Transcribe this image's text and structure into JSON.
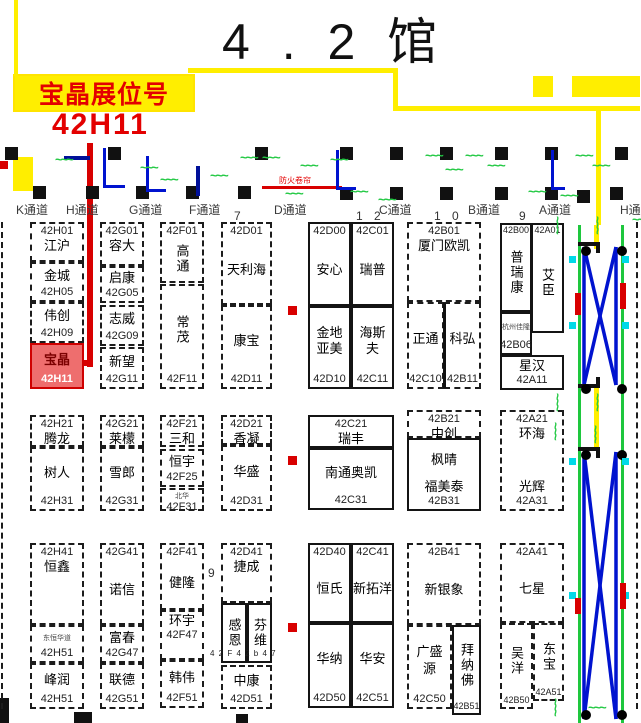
{
  "title": "4 . 2 馆",
  "banner": {
    "line1": "宝晶展位号",
    "line2": "42H11"
  },
  "fire_label": "防火卷帘",
  "labels": [
    {
      "t": "9",
      "x": 208,
      "y": 566,
      "c": "num9"
    },
    {
      "t": "4 2 F 4 2 b 4 7",
      "x": 210,
      "y": 649,
      "c": "cap"
    }
  ],
  "aisles": [
    {
      "t": "K通道",
      "x": 16
    },
    {
      "t": "H通道",
      "x": 66
    },
    {
      "t": "G通道",
      "x": 129
    },
    {
      "t": "F通道",
      "x": 189
    },
    {
      "t": "7",
      "x": 234,
      "num": true
    },
    {
      "t": "D通道",
      "x": 274
    },
    {
      "t": "1 2",
      "x": 356,
      "num": true
    },
    {
      "t": "C通道",
      "x": 379
    },
    {
      "t": "1 0",
      "x": 434,
      "num": true
    },
    {
      "t": "B通道",
      "x": 468
    },
    {
      "t": "9",
      "x": 519,
      "num": true
    },
    {
      "t": "A通道",
      "x": 539
    },
    {
      "t": "H通",
      "x": 620
    }
  ],
  "booths": [
    {
      "id": "42H01",
      "x": 30,
      "y": 222,
      "w": 54,
      "h": 40,
      "s": "dashed",
      "lines": [
        {
          "t": "42H01",
          "c": "id"
        },
        {
          "t": "江沪",
          "c": "nm"
        }
      ]
    },
    {
      "id": "42H05",
      "x": 30,
      "y": 262,
      "w": 54,
      "h": 40,
      "s": "dashed",
      "lines": [
        {
          "t": "金城",
          "c": "nm",
          "g": 1
        },
        {
          "t": "42H05",
          "c": "id"
        }
      ]
    },
    {
      "id": "42H09",
      "x": 30,
      "y": 302,
      "w": 54,
      "h": 41,
      "s": "dashed",
      "lines": [
        {
          "t": "伟创",
          "c": "nm",
          "g": 1
        },
        {
          "t": "42H09",
          "c": "id"
        }
      ]
    },
    {
      "id": "42H11",
      "x": 30,
      "y": 343,
      "w": 54,
      "h": 46,
      "s": "dashed",
      "hl": true,
      "lines": [
        {
          "t": "宝晶",
          "c": "nm",
          "g": 1
        },
        {
          "t": "42H11",
          "c": "id"
        }
      ]
    },
    {
      "id": "42G01",
      "x": 100,
      "y": 222,
      "w": 44,
      "h": 44,
      "s": "dashed",
      "lines": [
        {
          "t": "42G01",
          "c": "id"
        },
        {
          "t": "容大",
          "c": "nm"
        }
      ]
    },
    {
      "id": "42G05",
      "x": 100,
      "y": 266,
      "w": 44,
      "h": 37,
      "s": "dashed",
      "lines": [
        {
          "t": "启康",
          "c": "nm",
          "g": 1
        },
        {
          "t": "42G05",
          "c": "id"
        }
      ]
    },
    {
      "id": "42G09",
      "x": 100,
      "y": 305,
      "w": 44,
      "h": 41,
      "s": "dashed",
      "lines": [
        {
          "t": "志威",
          "c": "nm",
          "g": 1
        },
        {
          "t": "42G09",
          "c": "id"
        }
      ]
    },
    {
      "id": "42G11",
      "x": 100,
      "y": 347,
      "w": 44,
      "h": 42,
      "s": "dashed",
      "lines": [
        {
          "t": "新望",
          "c": "nm",
          "g": 1
        },
        {
          "t": "42G11",
          "c": "id"
        }
      ]
    },
    {
      "id": "42F01",
      "x": 160,
      "y": 222,
      "w": 44,
      "h": 61,
      "s": "dashed",
      "lines": [
        {
          "t": "42F01",
          "c": "id"
        },
        {
          "t": "高通",
          "c": "vm"
        }
      ]
    },
    {
      "id": "42F11",
      "x": 160,
      "y": 284,
      "w": 44,
      "h": 105,
      "s": "dashed",
      "lines": [
        {
          "t": "常茂",
          "c": "vm"
        },
        {
          "t": "42F11",
          "c": "id"
        }
      ]
    },
    {
      "id": "42D01",
      "x": 221,
      "y": 222,
      "w": 51,
      "h": 83,
      "s": "dashed",
      "lines": [
        {
          "t": "42D01",
          "c": "id"
        },
        {
          "t": "天利海",
          "c": "nm",
          "g": 1
        }
      ]
    },
    {
      "id": "42D11",
      "x": 221,
      "y": 305,
      "w": 51,
      "h": 84,
      "s": "dashed",
      "lines": [
        {
          "t": "康宝",
          "c": "nm",
          "g": 1
        },
        {
          "t": "42D11",
          "c": "id"
        }
      ]
    },
    {
      "id": "42D00",
      "x": 308,
      "y": 222,
      "w": 43,
      "h": 84,
      "s": "solid",
      "lines": [
        {
          "t": "42D00",
          "c": "id"
        },
        {
          "t": "安心",
          "c": "nm",
          "g": 1
        }
      ]
    },
    {
      "id": "42C01",
      "x": 351,
      "y": 222,
      "w": 43,
      "h": 84,
      "s": "solid",
      "lines": [
        {
          "t": "42C01",
          "c": "id"
        },
        {
          "t": "瑞普",
          "c": "nm",
          "g": 1
        }
      ]
    },
    {
      "id": "42D10",
      "x": 308,
      "y": 306,
      "w": 43,
      "h": 83,
      "s": "solid",
      "lines": [
        {
          "c": "sp",
          "g": 1
        },
        {
          "t": "金地",
          "c": "nm"
        },
        {
          "t": "亚美",
          "c": "nm"
        },
        {
          "c": "sp",
          "g": 1
        },
        {
          "t": "42D10",
          "c": "id"
        }
      ]
    },
    {
      "id": "42C11",
      "x": 351,
      "y": 306,
      "w": 43,
      "h": 83,
      "s": "solid",
      "lines": [
        {
          "c": "sp",
          "g": 1
        },
        {
          "t": "海斯",
          "c": "nm"
        },
        {
          "t": "夫",
          "c": "nm"
        },
        {
          "c": "sp",
          "g": 1
        },
        {
          "t": "42C11",
          "c": "id"
        }
      ]
    },
    {
      "id": "42B01",
      "x": 407,
      "y": 222,
      "w": 74,
      "h": 80,
      "s": "dashed",
      "lines": [
        {
          "t": "42B01",
          "c": "id"
        },
        {
          "t": "厦门欧凯",
          "c": "nm"
        }
      ]
    },
    {
      "id": "42C10",
      "x": 407,
      "y": 302,
      "w": 37,
      "h": 87,
      "s": "dashed",
      "lines": [
        {
          "t": "正通",
          "c": "nm",
          "g": 1
        },
        {
          "t": "42C10",
          "c": "id"
        }
      ]
    },
    {
      "id": "42B11",
      "x": 444,
      "y": 302,
      "w": 37,
      "h": 87,
      "s": "dashed",
      "lines": [
        {
          "t": "科弘",
          "c": "nm",
          "g": 1
        },
        {
          "t": "42B11",
          "c": "id"
        }
      ]
    },
    {
      "id": "42B00",
      "x": 500,
      "y": 223,
      "w": 32,
      "h": 89,
      "s": "solid",
      "lines": [
        {
          "t": "42B00",
          "c": "idt"
        },
        {
          "t": "普瑞康",
          "c": "vm"
        }
      ]
    },
    {
      "id": "42A01",
      "x": 531,
      "y": 223,
      "w": 33,
      "h": 110,
      "s": "solid",
      "lines": [
        {
          "t": "42A01",
          "c": "idt"
        },
        {
          "t": "艾臣",
          "c": "vm"
        }
      ]
    },
    {
      "id": "42B06",
      "x": 500,
      "y": 312,
      "w": 32,
      "h": 43,
      "s": "solid",
      "lines": [
        {
          "t": "杭州佳隆",
          "c": "ty",
          "g": 1
        },
        {
          "t": "42B06",
          "c": "id"
        }
      ]
    },
    {
      "id": "42A11",
      "x": 500,
      "y": 355,
      "w": 64,
      "h": 35,
      "s": "solid",
      "lines": [
        {
          "t": "星汉",
          "c": "nm",
          "g": 1
        },
        {
          "t": "42A11",
          "c": "id"
        }
      ]
    },
    {
      "id": "42H21",
      "x": 30,
      "y": 415,
      "w": 54,
      "h": 32,
      "s": "dashed",
      "lines": [
        {
          "t": "42H21",
          "c": "id"
        },
        {
          "t": "腾龙",
          "c": "nm"
        }
      ]
    },
    {
      "id": "42H31",
      "x": 30,
      "y": 447,
      "w": 54,
      "h": 64,
      "s": "dashed",
      "lines": [
        {
          "t": "树人",
          "c": "nm",
          "g": 1
        },
        {
          "t": "42H31",
          "c": "id"
        }
      ]
    },
    {
      "id": "42G21",
      "x": 100,
      "y": 415,
      "w": 44,
      "h": 32,
      "s": "dashed",
      "lines": [
        {
          "t": "42G21",
          "c": "id"
        },
        {
          "t": "莱檬",
          "c": "nm"
        }
      ]
    },
    {
      "id": "42G31",
      "x": 100,
      "y": 447,
      "w": 44,
      "h": 64,
      "s": "dashed",
      "lines": [
        {
          "t": "雪郎",
          "c": "nm",
          "g": 1
        },
        {
          "t": "42G31",
          "c": "id"
        }
      ]
    },
    {
      "id": "42F21",
      "x": 160,
      "y": 415,
      "w": 44,
      "h": 32,
      "s": "dashed",
      "lines": [
        {
          "t": "42F21",
          "c": "id"
        },
        {
          "t": "三和",
          "c": "nm"
        }
      ]
    },
    {
      "id": "42F25",
      "x": 160,
      "y": 449,
      "w": 44,
      "h": 38,
      "s": "dashed",
      "lines": [
        {
          "t": "恒宇",
          "c": "nm",
          "g": 1
        },
        {
          "t": "42F25",
          "c": "id"
        }
      ]
    },
    {
      "id": "42F31",
      "x": 160,
      "y": 488,
      "w": 44,
      "h": 23,
      "s": "dashed",
      "lines": [
        {
          "t": "北华",
          "c": "ty"
        },
        {
          "t": "42F31",
          "c": "id"
        }
      ]
    },
    {
      "id": "42D21",
      "x": 221,
      "y": 415,
      "w": 51,
      "h": 30,
      "s": "dashed",
      "lines": [
        {
          "t": "42D21",
          "c": "id"
        },
        {
          "t": "香凝",
          "c": "nm"
        }
      ]
    },
    {
      "id": "42D31",
      "x": 221,
      "y": 445,
      "w": 51,
      "h": 66,
      "s": "dashed",
      "lines": [
        {
          "t": "华盛",
          "c": "nm",
          "g": 1
        },
        {
          "t": "42D31",
          "c": "id"
        }
      ]
    },
    {
      "id": "42C21",
      "x": 308,
      "y": 415,
      "w": 86,
      "h": 33,
      "s": "solid",
      "lines": [
        {
          "t": "42C21",
          "c": "id"
        },
        {
          "t": "瑞丰",
          "c": "nm"
        }
      ]
    },
    {
      "id": "42C31",
      "x": 308,
      "y": 448,
      "w": 86,
      "h": 62,
      "s": "solid",
      "lines": [
        {
          "t": "南通奥凯",
          "c": "nm",
          "g": 1
        },
        {
          "t": "42C31",
          "c": "id"
        }
      ]
    },
    {
      "id": "42B21",
      "x": 407,
      "y": 410,
      "w": 74,
      "h": 28,
      "s": "dashed",
      "lines": [
        {
          "t": "42B21",
          "c": "id"
        },
        {
          "t": "中创",
          "c": "nm"
        }
      ]
    },
    {
      "id": "42B31",
      "x": 407,
      "y": 438,
      "w": 74,
      "h": 73,
      "s": "solid",
      "lines": [
        {
          "c": "sp",
          "g": 1
        },
        {
          "t": "枫晴",
          "c": "nm"
        },
        {
          "c": "sp",
          "g": 1
        },
        {
          "t": "福美泰",
          "c": "nm"
        },
        {
          "t": "42B31",
          "c": "id"
        }
      ]
    },
    {
      "id": "42A21",
      "x": 500,
      "y": 410,
      "w": 64,
      "h": 101,
      "s": "dashed",
      "lines": [
        {
          "t": "42A21",
          "c": "id"
        },
        {
          "t": "环海",
          "c": "nm"
        },
        {
          "c": "sp",
          "g": 1
        },
        {
          "t": "光辉",
          "c": "nm"
        },
        {
          "t": "42A31",
          "c": "id"
        }
      ]
    },
    {
      "id": "42H41",
      "x": 30,
      "y": 543,
      "w": 54,
      "h": 82,
      "s": "dashed",
      "lines": [
        {
          "t": "42H41",
          "c": "id"
        },
        {
          "t": "恒鑫",
          "c": "nm"
        },
        {
          "c": "sp",
          "g": 1
        }
      ]
    },
    {
      "id": "42H51a",
      "x": 30,
      "y": 625,
      "w": 54,
      "h": 38,
      "s": "dashed",
      "lines": [
        {
          "t": "东恒华道",
          "c": "ty",
          "g": 1
        },
        {
          "t": "42H51",
          "c": "id"
        }
      ]
    },
    {
      "id": "42H51b",
      "x": 30,
      "y": 663,
      "w": 54,
      "h": 46,
      "s": "dashed",
      "lines": [
        {
          "t": "峰润",
          "c": "nm",
          "g": 1
        },
        {
          "t": "42H51",
          "c": "id"
        }
      ]
    },
    {
      "id": "42G41",
      "x": 100,
      "y": 543,
      "w": 44,
      "h": 82,
      "s": "dashed",
      "lines": [
        {
          "t": "42G41",
          "c": "id"
        },
        {
          "t": "诺信",
          "c": "nm",
          "g": 1
        }
      ]
    },
    {
      "id": "42G47",
      "x": 100,
      "y": 625,
      "w": 44,
      "h": 38,
      "s": "dashed",
      "lines": [
        {
          "t": "富春",
          "c": "nm",
          "g": 1
        },
        {
          "t": "42G47",
          "c": "id"
        }
      ]
    },
    {
      "id": "42G51",
      "x": 100,
      "y": 663,
      "w": 44,
      "h": 46,
      "s": "dashed",
      "lines": [
        {
          "t": "联德",
          "c": "nm",
          "g": 1
        },
        {
          "t": "42G51",
          "c": "id"
        }
      ]
    },
    {
      "id": "42F41",
      "x": 160,
      "y": 543,
      "w": 44,
      "h": 67,
      "s": "dashed",
      "lines": [
        {
          "t": "42F41",
          "c": "id"
        },
        {
          "t": "健隆",
          "c": "nm",
          "g": 1
        }
      ]
    },
    {
      "id": "42F47",
      "x": 160,
      "y": 610,
      "w": 44,
      "h": 50,
      "s": "dashed",
      "lines": [
        {
          "t": "环宇",
          "c": "nm"
        },
        {
          "t": "42F47",
          "c": "id"
        },
        {
          "c": "sp",
          "g": 1
        }
      ]
    },
    {
      "id": "42F51",
      "x": 160,
      "y": 660,
      "w": 44,
      "h": 48,
      "s": "dashed",
      "lines": [
        {
          "t": "韩伟",
          "c": "nm",
          "g": 1
        },
        {
          "t": "42F51",
          "c": "id"
        }
      ]
    },
    {
      "id": "42D41",
      "x": 221,
      "y": 543,
      "w": 51,
      "h": 60,
      "s": "dashed",
      "lines": [
        {
          "t": "42D41",
          "c": "id"
        },
        {
          "t": "捷成",
          "c": "nm"
        }
      ]
    },
    {
      "id": "ganen",
      "x": 221,
      "y": 603,
      "w": 26,
      "h": 60,
      "s": "solid",
      "lines": [
        {
          "t": "感恩",
          "c": "vm"
        }
      ]
    },
    {
      "id": "fenwei",
      "x": 247,
      "y": 603,
      "w": 25,
      "h": 60,
      "s": "solid",
      "lines": [
        {
          "t": "芬维",
          "c": "vm"
        }
      ]
    },
    {
      "id": "42D51",
      "x": 221,
      "y": 665,
      "w": 51,
      "h": 44,
      "s": "dashed",
      "lines": [
        {
          "t": "中康",
          "c": "nm",
          "g": 1
        },
        {
          "t": "42D51",
          "c": "id"
        }
      ]
    },
    {
      "id": "42D40",
      "x": 308,
      "y": 543,
      "w": 43,
      "h": 80,
      "s": "solid",
      "lines": [
        {
          "t": "42D40",
          "c": "id"
        },
        {
          "t": "恒氏",
          "c": "nm",
          "g": 1
        }
      ]
    },
    {
      "id": "42C41",
      "x": 351,
      "y": 543,
      "w": 43,
      "h": 80,
      "s": "solid",
      "lines": [
        {
          "t": "42C41",
          "c": "id"
        },
        {
          "t": "新拓洋",
          "c": "nm",
          "g": 1
        }
      ]
    },
    {
      "id": "42D50",
      "x": 308,
      "y": 623,
      "w": 43,
      "h": 85,
      "s": "solid",
      "lines": [
        {
          "t": "华纳",
          "c": "nm",
          "g": 1
        },
        {
          "t": "42D50",
          "c": "id"
        }
      ]
    },
    {
      "id": "42C51",
      "x": 351,
      "y": 623,
      "w": 43,
      "h": 85,
      "s": "solid",
      "lines": [
        {
          "t": "华安",
          "c": "nm",
          "g": 1
        },
        {
          "t": "42C51",
          "c": "id"
        }
      ]
    },
    {
      "id": "42B41",
      "x": 407,
      "y": 543,
      "w": 74,
      "h": 82,
      "s": "dashed",
      "lines": [
        {
          "t": "42B41",
          "c": "id"
        },
        {
          "t": "新银象",
          "c": "nm",
          "g": 1
        }
      ]
    },
    {
      "id": "42C50",
      "x": 407,
      "y": 625,
      "w": 45,
      "h": 84,
      "s": "dashed",
      "lines": [
        {
          "c": "sp",
          "g": 1
        },
        {
          "t": "广盛",
          "c": "nm"
        },
        {
          "t": "源",
          "c": "nm"
        },
        {
          "c": "sp",
          "g": 1
        },
        {
          "t": "42C50",
          "c": "id"
        }
      ]
    },
    {
      "id": "42B51",
      "x": 452,
      "y": 625,
      "w": 29,
      "h": 90,
      "s": "solid",
      "lines": [
        {
          "t": "拜纳佛",
          "c": "vm"
        },
        {
          "t": "42B51",
          "c": "idt"
        }
      ]
    },
    {
      "id": "42A41",
      "x": 500,
      "y": 543,
      "w": 64,
      "h": 80,
      "s": "dashed",
      "lines": [
        {
          "t": "42A41",
          "c": "id"
        },
        {
          "t": "七星",
          "c": "nm",
          "g": 1
        }
      ]
    },
    {
      "id": "42B50",
      "x": 500,
      "y": 623,
      "w": 33,
      "h": 86,
      "s": "dashed",
      "lines": [
        {
          "t": "吴洋",
          "c": "vm"
        },
        {
          "t": "42B50",
          "c": "idt"
        }
      ]
    },
    {
      "id": "42A51",
      "x": 533,
      "y": 623,
      "w": 31,
      "h": 78,
      "s": "dashed",
      "lines": [
        {
          "t": "东宝",
          "c": "vm"
        },
        {
          "t": "42A51",
          "c": "idt"
        }
      ]
    }
  ]
}
